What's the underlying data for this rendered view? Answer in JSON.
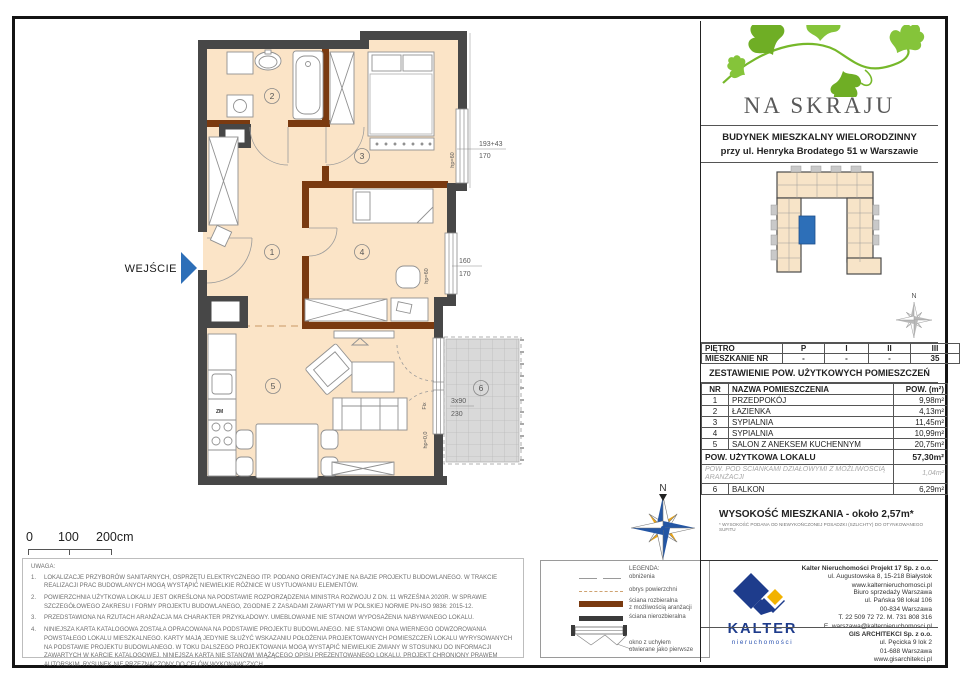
{
  "brand": {
    "name": "NA SKRAJU"
  },
  "building": {
    "line1": "BUDYNEK MIESZKALNY WIELORODZINNY",
    "line2": "przy ul. Henryka Brodatego 51 w Warszawie"
  },
  "floor_table": {
    "row1_label": "PIĘTRO",
    "row1": [
      "P",
      "I",
      "II",
      "III"
    ],
    "row2_label": "MIESZKANIE NR",
    "row2": [
      "-",
      "-",
      "-",
      "35"
    ]
  },
  "area_table": {
    "title": "ZESTAWIENIE POW. UŻYTKOWYCH POMIESZCZEŃ",
    "col_nr": "NR",
    "col_name": "NAZWA POMIESZCZENIA",
    "col_area": "POW. (m²)",
    "rooms": [
      {
        "nr": "1",
        "name": "PRZEDPOKÓJ",
        "area": "9,98m²"
      },
      {
        "nr": "2",
        "name": "ŁAZIENKA",
        "area": "4,13m²"
      },
      {
        "nr": "3",
        "name": "SYPIALNIA",
        "area": "11,45m²"
      },
      {
        "nr": "4",
        "name": "SYPIALNIA",
        "area": "10,99m²"
      },
      {
        "nr": "5",
        "name": "SALON Z ANEKSEM KUCHENNYM",
        "area": "20,75m²"
      }
    ],
    "total_label": "POW. UŻYTKOWA LOKALU",
    "total_area": "57,30m²",
    "partition_label": "POW. POD ŚCIANKAMI DZIAŁOWYMI Z MOŻLIWOŚCIĄ ARANŻACJI",
    "partition_area": "1,04m²",
    "balcony_nr": "6",
    "balcony_label": "BALKON",
    "balcony_area": "6,29m²",
    "height_label": "WYSOKOŚĆ MIESZKANIA - około 2,57m*",
    "height_note": "* WYSOKOŚĆ PODANA OD NIEWYKOŃCZONEJ POSADZKI (SZLICHTY) DO OTYNKOWANEGO SUFITU"
  },
  "plan": {
    "entrance": "WEJŚCIE",
    "rooms": [
      "1",
      "2",
      "3",
      "4",
      "5",
      "6"
    ],
    "dim_win3_a": "193+43",
    "dim_win3_b": "170",
    "dim_win4_a": "160",
    "dim_win4_b": "170",
    "dim_balcony_a": "3x90",
    "dim_balcony_b": "230",
    "lbl_hp60_w3": "hp=60",
    "lbl_hp60_w4": "hp=60",
    "lbl_fix": "Fix",
    "lbl_hp0": "hp=0,0",
    "lbl_zm": "ZM",
    "north": "N",
    "north_small": "N"
  },
  "scalebar": {
    "zero": "0",
    "hundred": "100",
    "two_hundred": "200cm"
  },
  "notes": {
    "title": "UWAGA:",
    "items": [
      {
        "n": "1.",
        "t": "LOKALIZACJE PRZYBORÓW SANITARNYCH, OSPRZĘTU ELEKTRYCZNEGO ITP. PODANO ORIENTACYJNIE NA BAZIE PROJEKTU BUDOWLANEGO. W TRAKCIE REALIZACJI PRAC BUDOWLANYCH MOGĄ WYSTĄPIĆ NIEWIELKIE RÓŻNICE W USYTUOWANIU ELEMENTÓW."
      },
      {
        "n": "2.",
        "t": "POWIERZCHNIA UŻYTKOWA LOKALU JEST OKREŚLONA NA PODSTAWIE ROZPORZĄDZENIA MINISTRA ROZWOJU Z DN. 11 WRZEŚNIA 2020R. W SPRAWIE SZCZEGÓŁOWEGO ZAKRESU I FORMY PROJEKTU BUDOWLANEGO, ZGODNIE Z ZASADAMI ZAWARTYMI W POLSKIEJ NORMIE PN-ISO 9836: 2015-12."
      },
      {
        "n": "3.",
        "t": "PRZEDSTAWIONA NA RZUTACH ARANŻACJA MA CHARAKTER PRZYKŁADOWY. UMEBLOWANIE NIE STANOWI WYPOSAŻENIA NABYWANEGO LOKALU."
      },
      {
        "n": "4.",
        "t": "NINIEJSZA KARTA KATALOGOWA ZOSTAŁA OPRACOWANA NA PODSTAWIE PROJEKTU BUDOWLANEGO. NIE STANOWI ONA WIERNEGO ODWZOROWANIA POWSTAŁEGO LOKALU MIESZKALNEGO. KARTY MAJĄ JEDYNIE SŁUŻYĆ WSKAZANIU POŁOŻENIA PROJEKTOWANYCH POMIESZCZEŃ LOKALU WYRYSOWANYCH NA PODSTAWIE PROJEKTU BUDOWLANEGO. W TOKU DALSZEGO PROJEKTOWANIA MOGĄ WYSTĄPIĆ NIEWIELKIE ZMIANY W STOSUNKU DO INFORMACJI ZAWARTYCH W KARCIE KATALOGOWEJ. NINIEJSZA KARTA NIE STANOWI WIĄŻĄCEGO OPISU PREZENTOWANEGO LOKALU. PROJEKT CHRONIONY PRAWEM AUTORSKIM. RYSUNEK NIE PRZEZNACZONY DO CELÓW WYKONAWCZYCH."
      }
    ]
  },
  "legend": {
    "title": "LEGENDA:",
    "item1": "obniżenia",
    "item2": "obrys powierzchni",
    "item3a": "ściana rozbieralna",
    "item3b": "z możliwością aranżacji",
    "item4": "ściana nierozbieralna",
    "item5a": "okno z uchyłem",
    "item5b": "otwierane jako pierwsze"
  },
  "contacts": {
    "kalter_wordmark": "KALTER",
    "kalter_sub": "nieruchomości",
    "hq": {
      "l1": "Kalter Nieruchomości Projekt 17 Sp. z o.o.",
      "l2": "ul. Augustowska 8, 15-218 Białystok",
      "l3": "www.kalternieruchomosci.pl"
    },
    "office": {
      "l1": "Biuro sprzedaży Warszawa",
      "l2": "ul. Pańska 98 lokal 106",
      "l3": "00-834 Warszawa",
      "l4": "T. 22 509 72 72. M. 731 808 316",
      "l5": "E. warszawa@kalternieruchomosci.pl"
    },
    "gis": {
      "l1": "GIS ARCHITEKCI Sp. z o.o.",
      "l2": "ul. Pęcicka 9 lok 2",
      "l3": "01-688 Warszawa",
      "l4": "www.gisarchitekci.pl"
    }
  },
  "colors": {
    "room_fill": "#fbe4c7",
    "wall_dark": "#474747",
    "wall_removable": "#7a3a10",
    "accent_blue": "#2d6fb8",
    "balcony_gray": "#d9d9d9",
    "ivy_green": "#76b82a",
    "kalter_navy": "#1e3c8c",
    "kalter_yellow": "#f2b200"
  }
}
